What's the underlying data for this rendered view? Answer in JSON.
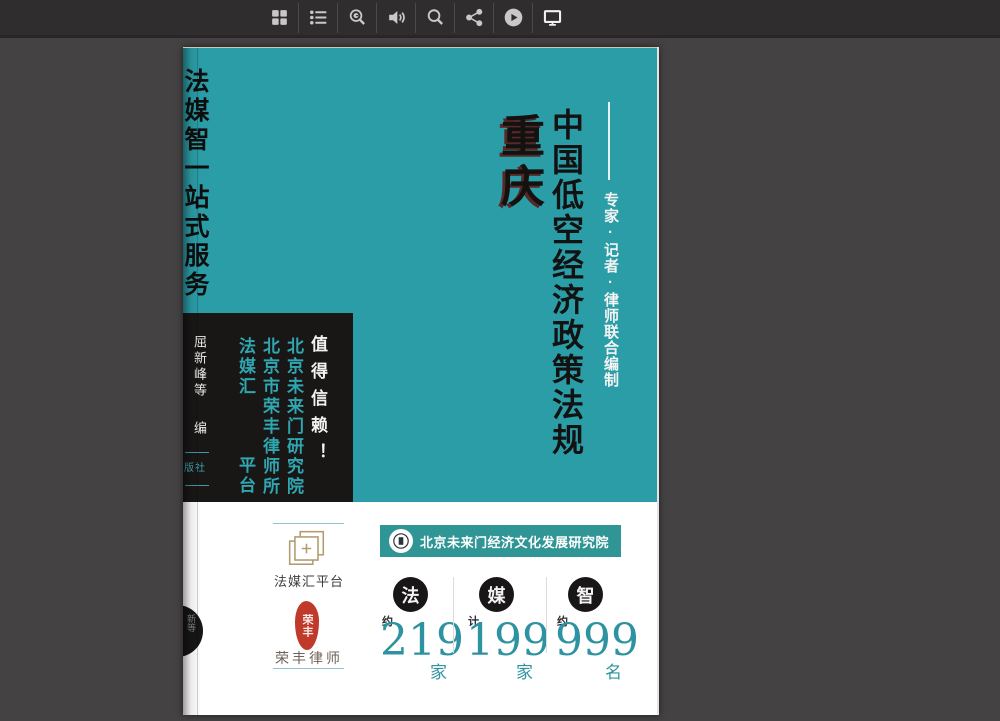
{
  "toolbar": {
    "icons": [
      {
        "name": "grid-icon"
      },
      {
        "name": "toc-list-icon"
      },
      {
        "name": "search-history-icon"
      },
      {
        "name": "volume-icon"
      },
      {
        "name": "search-icon"
      },
      {
        "name": "share-icon"
      },
      {
        "name": "play-icon"
      },
      {
        "name": "monitor-icon"
      }
    ]
  },
  "cover": {
    "left_slogan": "法媒智一站式服务",
    "region_label": "重庆",
    "main_title": "中国低空经济政策法规",
    "editors_note": "专家·记者·律师联合编制",
    "black_box": {
      "authors": "屈新峰等",
      "editor_label": "编",
      "publisher_partial": "版社",
      "org_platform_top": "法媒汇",
      "org_platform_bottom": "平台",
      "org_lawfirm": "北京市荣丰律师所",
      "org_institute": "北京未来门研究院",
      "tagline": "值得信赖！"
    }
  },
  "footer": {
    "platform_label": "法媒汇平台",
    "seal_text": "荣丰",
    "lawfirm_label": "荣丰律师",
    "institute_banner": "北京未来门经济文化发展研究院",
    "stats": [
      {
        "badge": "法",
        "qualifier": "约",
        "value": "219",
        "unit": "家"
      },
      {
        "badge": "媒",
        "qualifier": "计",
        "value": "199",
        "unit": "家"
      },
      {
        "badge": "智",
        "qualifier": "约",
        "value": "999",
        "unit": "名"
      }
    ],
    "edge_badge_text": "新等"
  },
  "colors": {
    "cover_teal": "#2b9da7",
    "banner_teal": "#2f9595",
    "number_teal": "#2e93a0",
    "box_black": "#191616",
    "seal_red": "#bf3a2b",
    "logo_gold": "#b39c72",
    "window_background": "#454243",
    "toolbar_background": "#302d2e"
  }
}
